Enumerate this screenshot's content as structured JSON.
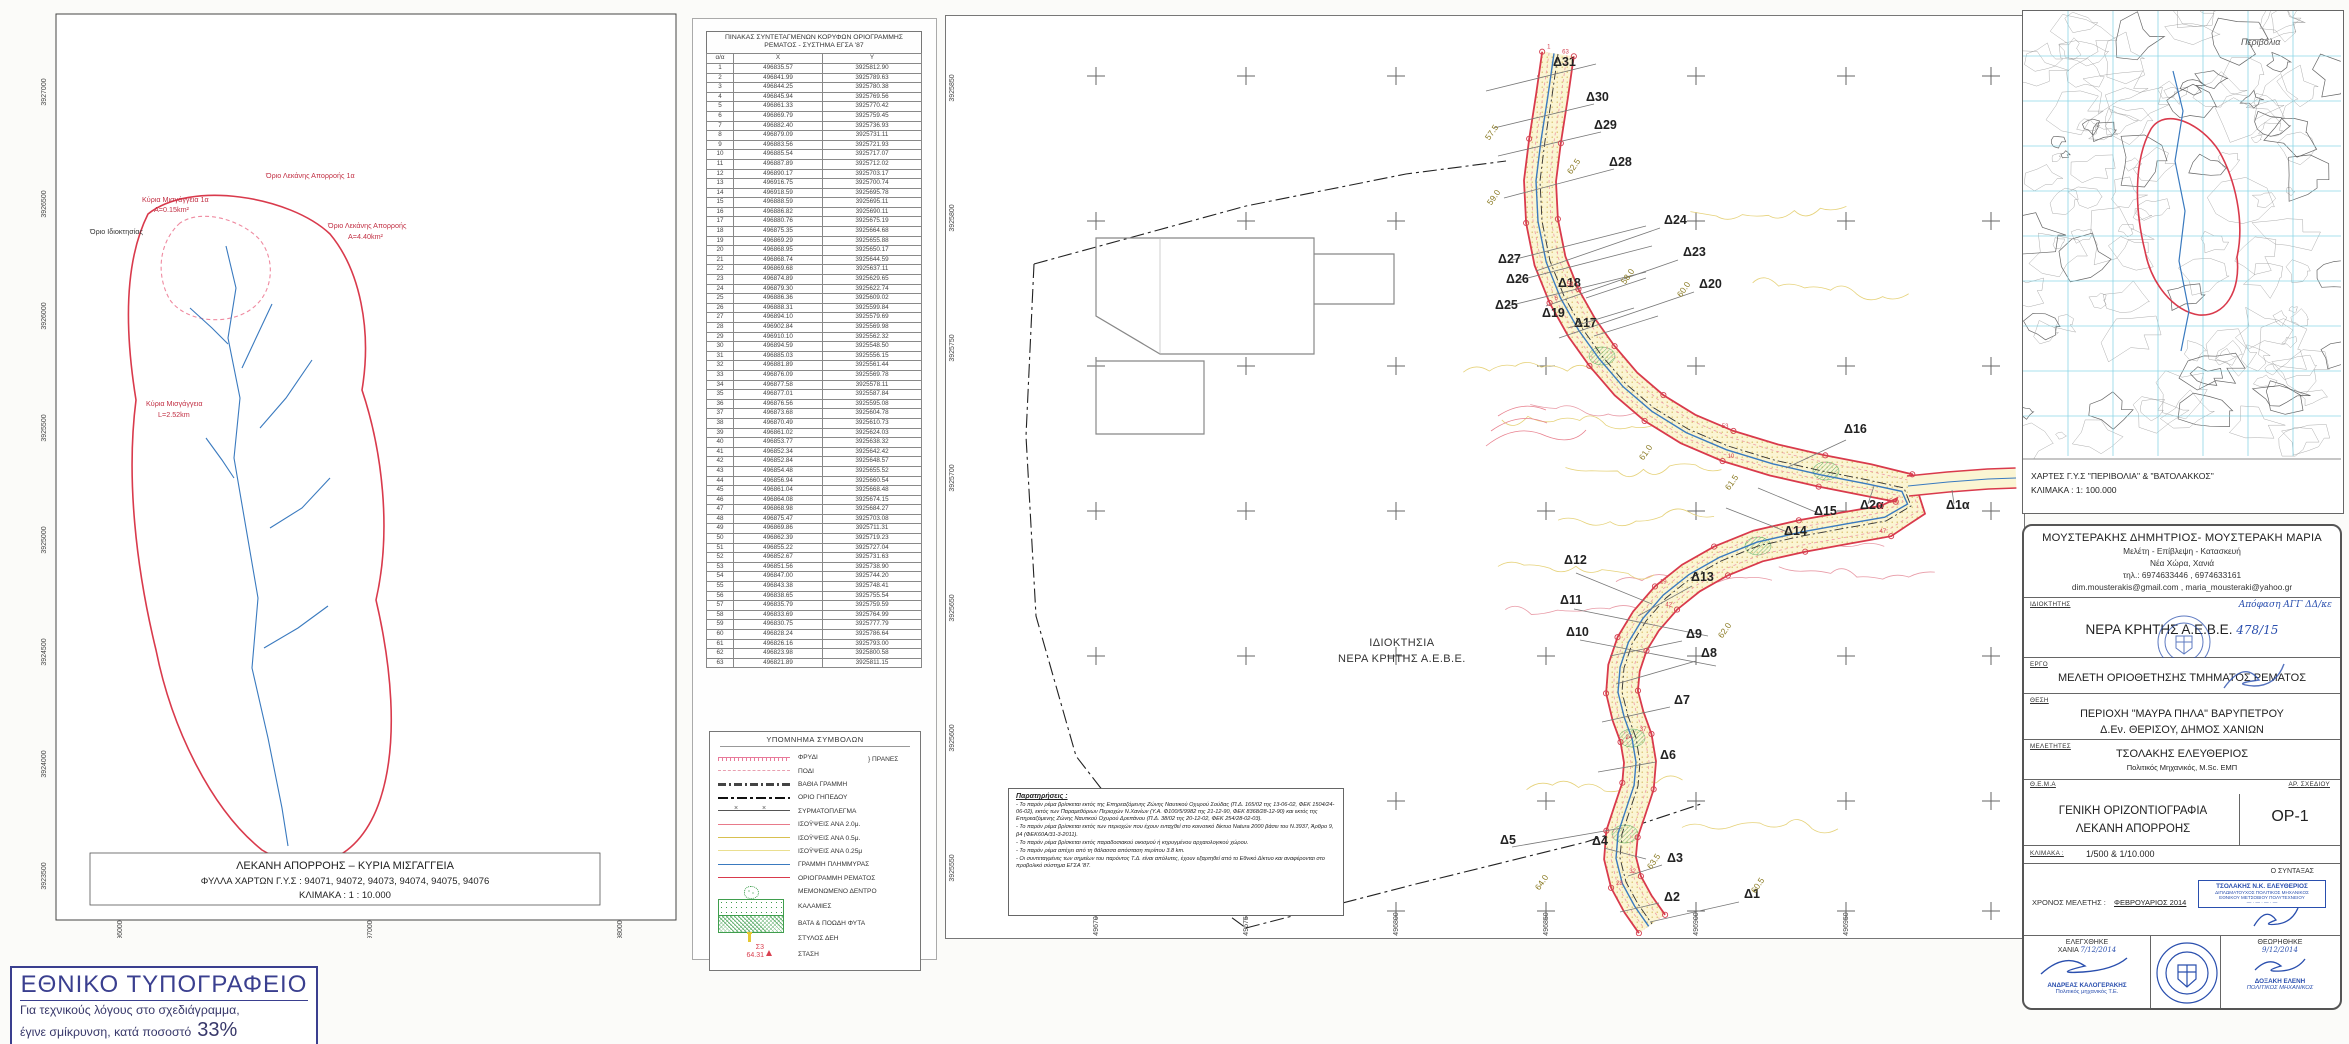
{
  "colors": {
    "stream_red": "#d93a4c",
    "flood_blue": "#3a7abf",
    "contour_yellow": "#d8c050",
    "veg_green": "#3f9e4d",
    "stamp_blue": "#2a4fae",
    "nat_blue": "#3a3f8f"
  },
  "left_map": {
    "caption_line1": "ΛΕΚΑΝΗ ΑΠΟΡΡΟΗΣ – ΚΥΡΙΑ ΜΙΣΓΑΓΓΕΙΑ",
    "caption_line2": "ΦΥΛΛΑ ΧΑΡΤΩΝ Γ.Υ.Σ : 94071, 94072, 94073, 94074, 94075, 94076",
    "caption_line3": "ΚΛΙΜΑΚΑ : 1 : 10.000",
    "y_labels": [
      "3927000",
      "3926500",
      "3926000",
      "3925500",
      "3925000",
      "3924500",
      "3924000",
      "3923500"
    ],
    "x_labels": [
      "496000",
      "497000",
      "498000"
    ],
    "annotations": [
      {
        "text": "Κύρια Μισγάγγεια 1α",
        "x": 112,
        "y": 194,
        "c": "red"
      },
      {
        "text": "Α=0.15km²",
        "x": 124,
        "y": 204,
        "c": "red"
      },
      {
        "text": "Όριο Ιδιοκτησίας",
        "x": 60,
        "y": 226,
        "c": "dark"
      },
      {
        "text": "Όριο Λεκάνης Απορροής 1α",
        "x": 236,
        "y": 170,
        "c": "red"
      },
      {
        "text": "Όριο Λεκάνης Απορροής",
        "x": 298,
        "y": 220,
        "c": "red"
      },
      {
        "text": "Α=4.40km²",
        "x": 318,
        "y": 231,
        "c": "red"
      },
      {
        "text": "Κύρια Μισγάγγεια",
        "x": 116,
        "y": 398,
        "c": "red"
      },
      {
        "text": "L=2.52km",
        "x": 128,
        "y": 409,
        "c": "red"
      }
    ]
  },
  "coord_table": {
    "title_line1": "ΠΙΝΑΚΑΣ ΣΥΝΤΕΤΑΓΜΕΝΩΝ ΚΟΡΥΦΩΝ ΟΡΙΟΓΡΑΜΜΗΣ",
    "title_line2": "ΡΕΜΑΤΟΣ - ΣΥΣΤΗΜΑ ΕΓΣΑ '87",
    "columns": [
      "α/α",
      "Χ",
      "Υ"
    ],
    "rows": [
      [
        "1",
        "496835.57",
        "3925812.90"
      ],
      [
        "2",
        "496841.99",
        "3925789.63"
      ],
      [
        "3",
        "496844.25",
        "3925780.38"
      ],
      [
        "4",
        "496845.94",
        "3925769.56"
      ],
      [
        "5",
        "496861.33",
        "3925770.42"
      ],
      [
        "6",
        "496869.79",
        "3925759.45"
      ],
      [
        "7",
        "496882.40",
        "3925736.93"
      ],
      [
        "8",
        "496879.09",
        "3925731.11"
      ],
      [
        "9",
        "496883.56",
        "3925721.93"
      ],
      [
        "10",
        "496885.54",
        "3925717.07"
      ],
      [
        "11",
        "496887.89",
        "3925712.02"
      ],
      [
        "12",
        "496890.17",
        "3925703.17"
      ],
      [
        "13",
        "496916.75",
        "3925700.74"
      ],
      [
        "14",
        "496918.59",
        "3925695.78"
      ],
      [
        "15",
        "496888.59",
        "3925695.11"
      ],
      [
        "16",
        "496886.82",
        "3925690.11"
      ],
      [
        "17",
        "496880.76",
        "3925675.19"
      ],
      [
        "18",
        "496875.35",
        "3925664.68"
      ],
      [
        "19",
        "496869.29",
        "3925655.88"
      ],
      [
        "20",
        "496868.95",
        "3925650.17"
      ],
      [
        "21",
        "496868.74",
        "3925644.59"
      ],
      [
        "22",
        "496869.68",
        "3925637.11"
      ],
      [
        "23",
        "496874.89",
        "3925629.65"
      ],
      [
        "24",
        "496879.30",
        "3925622.74"
      ],
      [
        "25",
        "496886.36",
        "3925609.02"
      ],
      [
        "26",
        "496888.31",
        "3925599.84"
      ],
      [
        "27",
        "496894.10",
        "3925579.69"
      ],
      [
        "28",
        "496902.84",
        "3925569.98"
      ],
      [
        "29",
        "496910.10",
        "3925562.32"
      ],
      [
        "30",
        "496894.59",
        "3925548.50"
      ],
      [
        "31",
        "496885.03",
        "3925556.15"
      ],
      [
        "32",
        "496881.89",
        "3925561.44"
      ],
      [
        "33",
        "496876.09",
        "3925569.78"
      ],
      [
        "34",
        "496877.58",
        "3925578.11"
      ],
      [
        "35",
        "496877.01",
        "3925587.84"
      ],
      [
        "36",
        "496876.56",
        "3925595.08"
      ],
      [
        "37",
        "496873.68",
        "3925604.78"
      ],
      [
        "38",
        "496870.49",
        "3925610.73"
      ],
      [
        "39",
        "496861.02",
        "3925624.03"
      ],
      [
        "40",
        "496853.77",
        "3925638.32"
      ],
      [
        "41",
        "496852.34",
        "3925642.42"
      ],
      [
        "42",
        "496852.84",
        "3925648.57"
      ],
      [
        "43",
        "496854.48",
        "3925655.52"
      ],
      [
        "44",
        "496856.94",
        "3925660.54"
      ],
      [
        "45",
        "496861.04",
        "3925668.48"
      ],
      [
        "46",
        "496864.08",
        "3925674.15"
      ],
      [
        "47",
        "496868.98",
        "3925684.27"
      ],
      [
        "48",
        "496875.47",
        "3925703.08"
      ],
      [
        "49",
        "496869.86",
        "3925711.31"
      ],
      [
        "50",
        "496862.39",
        "3925719.23"
      ],
      [
        "51",
        "496855.22",
        "3925727.04"
      ],
      [
        "52",
        "496852.67",
        "3925731.63"
      ],
      [
        "53",
        "496851.56",
        "3925738.90"
      ],
      [
        "54",
        "496847.00",
        "3925744.20"
      ],
      [
        "55",
        "496843.38",
        "3925748.41"
      ],
      [
        "56",
        "496838.65",
        "3925755.54"
      ],
      [
        "57",
        "496835.79",
        "3925759.59"
      ],
      [
        "58",
        "496833.69",
        "3925764.99"
      ],
      [
        "59",
        "496830.75",
        "3925777.79"
      ],
      [
        "60",
        "496828.24",
        "3925786.64"
      ],
      [
        "61",
        "496826.16",
        "3925793.00"
      ],
      [
        "62",
        "496823.98",
        "3925800.58"
      ],
      [
        "63",
        "496821.89",
        "3925811.15"
      ]
    ]
  },
  "legend": {
    "title": "ΥΠΟΜΝΗΜΑ ΣΥΜΒΟΛΩΝ",
    "slope_group_label": "ΠΡΑΝΕΣ",
    "station": {
      "id": "Σ3",
      "elev": "64.31"
    },
    "items": [
      {
        "swatch": "slope-top",
        "label": "ΦΡΥΔΙ"
      },
      {
        "swatch": "slope-toe",
        "label": "ΠΟΔΙ"
      },
      {
        "swatch": "deep-line",
        "label": "ΒΑΘΙΑ ΓΡΑΜΜΗ"
      },
      {
        "swatch": "plot-boundary",
        "label": "ΟΡΙΟ ΓΗΠΕΔΟΥ"
      },
      {
        "swatch": "wire-fence",
        "label": "ΣΥΡΜΑΤΟΠΛΕΓΜΑ"
      },
      {
        "swatch": "contour-2m",
        "label": "ΙΣΟΫΨΕΙΣ ΑΝΑ 2.0μ."
      },
      {
        "swatch": "contour-05m",
        "label": "ΙΣΟΫΨΕΙΣ ΑΝΑ 0.5μ."
      },
      {
        "swatch": "contour-025m",
        "label": "ΙΣΟΫΨΕΙΣ ΑΝΑ 0.25μ"
      },
      {
        "swatch": "flood-line",
        "label": "ΓΡΑΜΜΗ ΠΛΗΜΜΥΡΑΣ"
      },
      {
        "swatch": "stream-boundary",
        "label": "ΟΡΙΟΓΡΑΜΜΗ ΡΕΜΑΤΟΣ"
      },
      {
        "swatch": "tree",
        "label": "ΜΕΜΟΝΩΜΕΝΟ ΔΕΝΤΡΟ"
      },
      {
        "swatch": "reeds",
        "label": "ΚΑΛΑΜΙΕΣ"
      },
      {
        "swatch": "brambles",
        "label": "ΒΑΤΑ &  ΠΟΩΔΗ ΦΥΤΑ"
      },
      {
        "swatch": "power-pole",
        "label": "ΣΤΥΛΟΣ ΔΕΗ"
      },
      {
        "swatch": "station",
        "label": "ΣΤΑΣΗ"
      }
    ]
  },
  "plan": {
    "property_label_line1": "ΙΔΙΟΚΤΗΣΙΑ",
    "property_label_line2": "ΝΕΡΑ ΚΡΗΤΗΣ Α.Ε.Β.Ε.",
    "notes_title": "Παρατηρήσεις :",
    "notes": [
      "- Το παρόν ρέμα βρίσκεται εκτός της Επηρεαζόμενης Ζώνης Ναυτικού Οχυρού Σούδας (Π.Δ. 165/02 της 13-06-02, ΦΕΚ 1504/24-06-02), εκτός των Παραμεθόριων Περιοχών Ν.Χανίων (Υ.Α. Φ100/5/9982 της 21-12-90, ΦΕΚ 8368/28-12-90) και εκτός της Επηρεαζόμενης Ζώνης Ναυτικού Οχυρού Δρεπάνου (Π.Δ. 38/02 της 20-12-02, ΦΕΚ 254/28-02-03).",
      "- Το παρόν ρέμα βρίσκεται εκτός των περιοχών που έχουν ενταχθεί στο κοινοτικό δίκτυο Natura 2000 βάσει του Ν.3937, Άρθρο 9, β4 (ΦΕΚ60Α/31-3-2011).",
      "- Το παρόν ρέμα βρίσκεται εκτός παραδοσιακού οικισμού ή κηρυγμένου αρχαιολογικού χώρου.",
      "- Το παρόν ρέμα απέχει από τη θάλασσα απόσταση περίπου  3.8 km.",
      "- Οι συντεταγμένες των σημείων του παρόντος Τ.Δ. είναι απόλυτες, έχουν εξαρτηθεί από το Εθνικό Δίκτυο και αναφέρονται στο προβολικό σύστημα ΕΓΣΑ '87."
    ],
    "x_labels": [
      "496700",
      "496750",
      "496800",
      "496850",
      "496900",
      "496950"
    ],
    "y_labels": [
      "3925850",
      "3925800",
      "3925750",
      "3925700",
      "3925650",
      "3925600",
      "3925550"
    ],
    "sections": [
      [
        "Δ31",
        607,
        50,
        540,
        75,
        650,
        48
      ],
      [
        "Δ30",
        640,
        85,
        548,
        112,
        648,
        88
      ],
      [
        "Δ29",
        648,
        113,
        552,
        140,
        655,
        116
      ],
      [
        "Δ28",
        663,
        150,
        558,
        182,
        668,
        153
      ],
      [
        "Δ27",
        552,
        247,
        566,
        244,
        700,
        210
      ],
      [
        "Δ26",
        560,
        267,
        574,
        264,
        706,
        230
      ],
      [
        "Δ25",
        549,
        293,
        562,
        290,
        700,
        256
      ],
      [
        "Δ24",
        718,
        208,
        590,
        255,
        714,
        212
      ],
      [
        "Δ23",
        737,
        240,
        600,
        290,
        732,
        244
      ],
      [
        "Δ20",
        753,
        272,
        613,
        322,
        748,
        276
      ],
      [
        "Δ18",
        612,
        271,
        640,
        282,
        700,
        262
      ],
      [
        "Δ17",
        628,
        311,
        648,
        320,
        712,
        300
      ],
      [
        "Δ19",
        596,
        301,
        622,
        312,
        688,
        292
      ],
      [
        "Δ16",
        898,
        417,
        840,
        452,
        900,
        424
      ],
      [
        "Δ15",
        868,
        499,
        812,
        472,
        872,
        497
      ],
      [
        "Δ14",
        838,
        519,
        780,
        492,
        844,
        517
      ],
      [
        "Δ2α",
        914,
        493,
        928,
        470,
        922,
        488
      ],
      [
        "Δ1α",
        1000,
        493,
        1006,
        474,
        1008,
        488
      ],
      [
        "Δ13",
        745,
        565,
        692,
        600,
        746,
        570
      ],
      [
        "Δ12",
        618,
        548,
        630,
        557,
        706,
        588
      ],
      [
        "Δ11",
        614,
        588,
        628,
        593,
        762,
        620
      ],
      [
        "Δ10",
        620,
        620,
        634,
        624,
        770,
        650
      ],
      [
        "Δ9",
        740,
        622,
        664,
        640,
        736,
        625
      ],
      [
        "Δ8",
        755,
        641,
        670,
        668,
        750,
        645
      ],
      [
        "Δ7",
        728,
        688,
        656,
        706,
        724,
        691
      ],
      [
        "Δ6",
        714,
        743,
        652,
        756,
        710,
        746
      ],
      [
        "Δ5",
        554,
        828,
        566,
        831,
        676,
        812
      ],
      [
        "Δ4",
        646,
        829,
        658,
        832,
        700,
        843
      ],
      [
        "Δ3",
        721,
        846,
        682,
        860,
        716,
        849
      ],
      [
        "Δ2",
        718,
        885,
        674,
        896,
        713,
        887
      ],
      [
        "Δ1",
        798,
        882,
        704,
        906,
        793,
        886
      ]
    ],
    "contour_labels": [
      [
        "57.5",
        548,
        118
      ],
      [
        "62.5",
        630,
        152
      ],
      [
        "59.0",
        550,
        183
      ],
      [
        "58.0",
        684,
        262
      ],
      [
        "60.0",
        740,
        275
      ],
      [
        "61.0",
        702,
        438
      ],
      [
        "61.5",
        788,
        468
      ],
      [
        "62.0",
        781,
        616
      ],
      [
        "63.5",
        710,
        847
      ],
      [
        "60.5",
        814,
        871
      ],
      [
        "64.0",
        598,
        868
      ]
    ]
  },
  "right_map": {
    "caption_line1": "ΧΑΡΤΕΣ Γ.Υ.Σ \"ΠΕΡΙΒΟΛΙΑ\" & \"ΒΑΤΟΛΑΚΚΟΣ\"",
    "caption_line2": "ΚΛΙΜΑΚΑ : 1: 100.000",
    "map_label": "Περιβόλια"
  },
  "title_block": {
    "company": {
      "name": "ΜΟΥΣΤΕΡΑΚΗΣ ΔΗΜΗΤΡΙΟΣ- ΜΟΥΣΤΕΡΑΚΗ ΜΑΡΙΑ",
      "services": "Μελέτη -  Επίβλεψη - Κατασκευή",
      "address": "Νέα Χώρα, Χανιά",
      "phone": "τηλ.: 6974633446  , 6974633161",
      "emails": "dim.mousterakis@gmail.com  ,  maria_mousteraki@yahoo.gr"
    },
    "owner_label": "ΙΔΙΟΚΤΗΤΗΣ",
    "owner": "ΝΕΡΑ ΚΡΗΤΗΣ Α.Ε.Β.Ε.",
    "owner_hw1": "478/15",
    "owner_hw2": "Απόφαση ΑΓΓ ΔΔ/κε",
    "project_label": "ΕΡΓΟ",
    "project": "ΜΕΛΕΤΗ ΟΡΙΟΘΕΤΗΣΗΣ ΤΜΗΜΑΤΟΣ ΡΕΜΑΤΟΣ",
    "location_label": "ΘΕΣΗ",
    "location1": "ΠΕΡΙΟΧΗ \"ΜΑΥΡΑ ΠΗΛΑ\" ΒΑΡΥΠΕΤΡΟΥ",
    "location2": "Δ.Εν. ΘΕΡΙΣΟΥ, ΔΗΜΟΣ ΧΑΝΙΩΝ",
    "designers_label": "ΜΕΛΕΤΗΤΕΣ",
    "designer": "ΤΣΟΛΑΚΗΣ ΕΛΕΥΘΕΡΙΟΣ",
    "designer_title": "Πολιτικός Μηχανικός, M.Sc. ΕΜΠ",
    "subject_label": "Θ.Ε.Μ.Α",
    "drawing_no_label": "ΑΡ.  ΣΧΕΔΙΟΥ",
    "subject1": "ΓΕΝΙΚΗ ΟΡΙΖΟΝΤΙΟΓΡΑΦΙΑ",
    "subject2": "ΛΕΚΑΝΗ ΑΠΟΡΡΟΗΣ",
    "drawing_no": "ΟΡ-1",
    "scale_label": "ΚΛΙΜΑΚΑ :",
    "scale": "1/500   &   1/10.000",
    "date_label": "ΧΡΟΝΟΣ  ΜΕΛΕΤΗΣ :",
    "date": "ΦΕΒΡΟΥΑΡΙΟΣ  2014",
    "author_label": "Ο  ΣΥΝΤΑΞΑΣ",
    "stamp": {
      "l1": "ΤΣΟΛΑΚΗΣ Ν.Κ. ΕΛΕΥΘΕΡΙΟΣ",
      "l2": "ΔΙΠΛΩΜΑΤΟΥΧΟΣ ΠΟΛΙΤΙΚΟΣ ΜΗΧΑΝΙΚΟΣ",
      "l3": "ΕΘΝΙΚΟΥ ΜΕΤΣΟΒΙΟΥ ΠΟΛΥΤΕΧΝΕΙΟΥ"
    },
    "checked_label": "ΕΛΕΓΧΘΗΚΕ",
    "checked_place": "ΧΑΝΙΑ",
    "checked_date": "7/12/2014",
    "checked_name": "ΑΝΔΡΕΑΣ ΚΑΛΟΓΕΡΑΚΗΣ",
    "checked_title": "Πολιτικός μηχανικός Τ.Ε.",
    "approved_label": "ΘΕΩΡΗΘΗΚΕ",
    "approved_date": "9/12/2014",
    "approved_name": "ΔΟΞΑΚΗ ΕΛΕΝΗ",
    "approved_title": "ΠΟΛΙΤΙΚΟΣ ΜΗΧΑΝΙΚΟΣ"
  },
  "nat_stamp": {
    "title": "ΕΘΝΙΚΟ ΤΥΠΟΓΡΑΦΕΙΟ",
    "line1": "Για τεχνικούς λόγους στο σχεδιάγραμμα,",
    "line2": "έγινε σμίκρυνση, κατά ποσοστό",
    "percent": "33%"
  }
}
